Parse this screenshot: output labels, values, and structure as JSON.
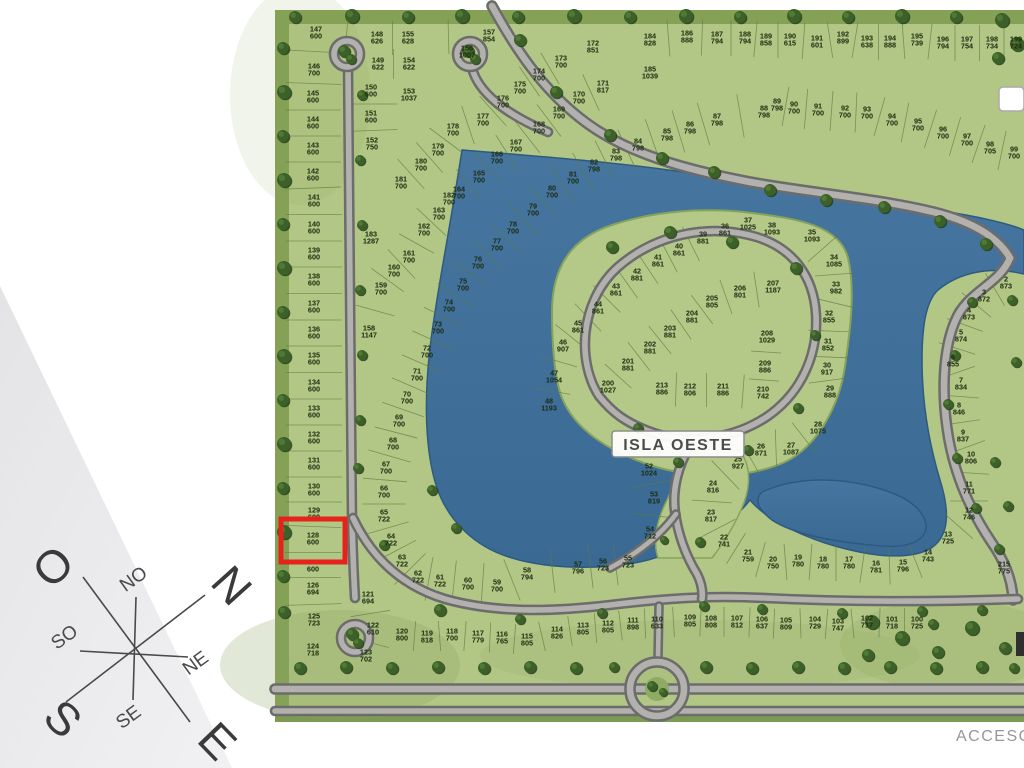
{
  "compass": {
    "directions": [
      {
        "id": "west",
        "label": "O"
      },
      {
        "id": "north",
        "label": "N"
      },
      {
        "id": "south",
        "label": "S"
      },
      {
        "id": "east",
        "label": "E"
      },
      {
        "id": "northwest",
        "label": "NO"
      },
      {
        "id": "southwest",
        "label": "SO"
      },
      {
        "id": "northeast",
        "label": "NE"
      },
      {
        "id": "southeast",
        "label": "SE"
      }
    ]
  },
  "map": {
    "island_label": "ISLA OESTE",
    "access_label": "ACCESO",
    "highlight": {
      "lot": 128,
      "x": 281,
      "y": 519,
      "w": 64,
      "h": 43
    },
    "colors": {
      "water": "#3f6f9b",
      "water_edge": "#2e5a80",
      "grass": "#b2c685",
      "grass_dark": "#84a156",
      "road": "#b3b1ae",
      "road_casing": "#6c6c6c",
      "tree": "#3c6028",
      "highlight": "#e5231b",
      "lot_text": "#1c2b10"
    },
    "lots": [
      {
        "n": 147,
        "a": 600,
        "x": 316,
        "y": 33
      },
      {
        "n": 146,
        "a": 700,
        "x": 314,
        "y": 70
      },
      {
        "n": 145,
        "a": 600,
        "x": 313,
        "y": 97
      },
      {
        "n": 144,
        "a": 600,
        "x": 313,
        "y": 123
      },
      {
        "n": 143,
        "a": 600,
        "x": 313,
        "y": 149
      },
      {
        "n": 142,
        "a": 600,
        "x": 313,
        "y": 175
      },
      {
        "n": 141,
        "a": 600,
        "x": 314,
        "y": 201
      },
      {
        "n": 140,
        "a": 600,
        "x": 314,
        "y": 228
      },
      {
        "n": 139,
        "a": 600,
        "x": 314,
        "y": 254
      },
      {
        "n": 138,
        "a": 600,
        "x": 314,
        "y": 280
      },
      {
        "n": 137,
        "a": 600,
        "x": 314,
        "y": 307
      },
      {
        "n": 136,
        "a": 600,
        "x": 314,
        "y": 333
      },
      {
        "n": 135,
        "a": 600,
        "x": 314,
        "y": 359
      },
      {
        "n": 134,
        "a": 600,
        "x": 314,
        "y": 386
      },
      {
        "n": 133,
        "a": 600,
        "x": 314,
        "y": 412
      },
      {
        "n": 132,
        "a": 600,
        "x": 314,
        "y": 438
      },
      {
        "n": 131,
        "a": 600,
        "x": 314,
        "y": 464
      },
      {
        "n": 130,
        "a": 600,
        "x": 314,
        "y": 490
      },
      {
        "n": 129,
        "a": 600,
        "x": 314,
        "y": 514
      },
      {
        "n": 128,
        "a": 600,
        "x": 313,
        "y": 539
      },
      {
        "n": 127,
        "a": 600,
        "x": 313,
        "y": 566
      },
      {
        "n": 126,
        "a": 694,
        "x": 313,
        "y": 589
      },
      {
        "n": 125,
        "a": 723,
        "x": 314,
        "y": 620
      },
      {
        "n": 124,
        "a": 718,
        "x": 313,
        "y": 650
      },
      {
        "n": 123,
        "a": 702,
        "x": 366,
        "y": 656
      },
      {
        "n": 122,
        "a": 610,
        "x": 373,
        "y": 629
      },
      {
        "n": 121,
        "a": 694,
        "x": 368,
        "y": 598
      },
      {
        "n": 148,
        "a": 626,
        "x": 377,
        "y": 38
      },
      {
        "n": 155,
        "a": 628,
        "x": 408,
        "y": 38
      },
      {
        "n": 157,
        "a": 854,
        "x": 489,
        "y": 36
      },
      {
        "n": 156,
        "a": 1007,
        "x": 467,
        "y": 52
      },
      {
        "n": 149,
        "a": 622,
        "x": 378,
        "y": 64
      },
      {
        "n": 154,
        "a": 622,
        "x": 409,
        "y": 64
      },
      {
        "n": 150,
        "a": 600,
        "x": 371,
        "y": 91
      },
      {
        "n": 153,
        "a": 1037,
        "x": 409,
        "y": 95
      },
      {
        "n": 151,
        "a": 600,
        "x": 371,
        "y": 117
      },
      {
        "n": 152,
        "a": 750,
        "x": 372,
        "y": 144
      },
      {
        "n": 183,
        "a": 1287,
        "x": 371,
        "y": 238
      },
      {
        "n": 158,
        "a": 1147,
        "x": 369,
        "y": 332
      },
      {
        "n": 159,
        "a": 700,
        "x": 381,
        "y": 289
      },
      {
        "n": 160,
        "a": 700,
        "x": 394,
        "y": 271
      },
      {
        "n": 161,
        "a": 700,
        "x": 409,
        "y": 257
      },
      {
        "n": 162,
        "a": 700,
        "x": 424,
        "y": 230
      },
      {
        "n": 163,
        "a": 700,
        "x": 439,
        "y": 214
      },
      {
        "n": 182,
        "a": 700,
        "x": 449,
        "y": 199
      },
      {
        "n": 164,
        "a": 700,
        "x": 459,
        "y": 193
      },
      {
        "n": 165,
        "a": 700,
        "x": 479,
        "y": 177
      },
      {
        "n": 166,
        "a": 700,
        "x": 497,
        "y": 158
      },
      {
        "n": 167,
        "a": 700,
        "x": 516,
        "y": 146
      },
      {
        "n": 168,
        "a": 700,
        "x": 539,
        "y": 128
      },
      {
        "n": 169,
        "a": 700,
        "x": 559,
        "y": 113
      },
      {
        "n": 170,
        "a": 700,
        "x": 579,
        "y": 98
      },
      {
        "n": 171,
        "a": 817,
        "x": 603,
        "y": 87
      },
      {
        "n": 172,
        "a": 851,
        "x": 593,
        "y": 47
      },
      {
        "n": 173,
        "a": 700,
        "x": 561,
        "y": 62
      },
      {
        "n": 174,
        "a": 700,
        "x": 539,
        "y": 75
      },
      {
        "n": 175,
        "a": 700,
        "x": 520,
        "y": 88
      },
      {
        "n": 176,
        "a": 700,
        "x": 503,
        "y": 102
      },
      {
        "n": 177,
        "a": 700,
        "x": 483,
        "y": 120
      },
      {
        "n": 178,
        "a": 700,
        "x": 453,
        "y": 130
      },
      {
        "n": 179,
        "a": 700,
        "x": 438,
        "y": 150
      },
      {
        "n": 180,
        "a": 700,
        "x": 421,
        "y": 165
      },
      {
        "n": 181,
        "a": 700,
        "x": 401,
        "y": 183
      },
      {
        "n": 184,
        "a": 828,
        "x": 650,
        "y": 40
      },
      {
        "n": 185,
        "a": 1039,
        "x": 650,
        "y": 73
      },
      {
        "n": 186,
        "a": 888,
        "x": 687,
        "y": 37
      },
      {
        "n": 187,
        "a": 794,
        "x": 717,
        "y": 38
      },
      {
        "n": 188,
        "a": 794,
        "x": 745,
        "y": 38
      },
      {
        "n": 189,
        "a": 858,
        "x": 766,
        "y": 40
      },
      {
        "n": 190,
        "a": 615,
        "x": 790,
        "y": 40
      },
      {
        "n": 191,
        "a": 601,
        "x": 817,
        "y": 42
      },
      {
        "n": 192,
        "a": 899,
        "x": 843,
        "y": 38
      },
      {
        "n": 193,
        "a": 638,
        "x": 867,
        "y": 42
      },
      {
        "n": 194,
        "a": 888,
        "x": 890,
        "y": 42
      },
      {
        "n": 195,
        "a": 739,
        "x": 917,
        "y": 40
      },
      {
        "n": 196,
        "a": 794,
        "x": 943,
        "y": 43
      },
      {
        "n": 197,
        "a": 754,
        "x": 967,
        "y": 43
      },
      {
        "n": 198,
        "a": 734,
        "x": 992,
        "y": 43
      },
      {
        "n": 199,
        "a": 724,
        "x": 1016,
        "y": 43
      },
      {
        "n": 89,
        "a": 798,
        "x": 777,
        "y": 105
      },
      {
        "n": 90,
        "a": 700,
        "x": 794,
        "y": 108
      },
      {
        "n": 91,
        "a": 700,
        "x": 818,
        "y": 110
      },
      {
        "n": 92,
        "a": 700,
        "x": 845,
        "y": 112
      },
      {
        "n": 93,
        "a": 700,
        "x": 867,
        "y": 113
      },
      {
        "n": 94,
        "a": 700,
        "x": 892,
        "y": 120
      },
      {
        "n": 95,
        "a": 700,
        "x": 918,
        "y": 125
      },
      {
        "n": 96,
        "a": 700,
        "x": 943,
        "y": 133
      },
      {
        "n": 97,
        "a": 700,
        "x": 967,
        "y": 140
      },
      {
        "n": 98,
        "a": 705,
        "x": 990,
        "y": 148
      },
      {
        "n": 99,
        "a": 700,
        "x": 1014,
        "y": 153
      },
      {
        "n": 88,
        "a": 798,
        "x": 764,
        "y": 112
      },
      {
        "n": 87,
        "a": 798,
        "x": 717,
        "y": 120
      },
      {
        "n": 86,
        "a": 798,
        "x": 690,
        "y": 128
      },
      {
        "n": 85,
        "a": 798,
        "x": 667,
        "y": 135
      },
      {
        "n": 84,
        "a": 798,
        "x": 638,
        "y": 145
      },
      {
        "n": 83,
        "a": 798,
        "x": 616,
        "y": 155
      },
      {
        "n": 82,
        "a": 798,
        "x": 594,
        "y": 166
      },
      {
        "n": 81,
        "a": 700,
        "x": 573,
        "y": 178
      },
      {
        "n": 80,
        "a": 700,
        "x": 552,
        "y": 192
      },
      {
        "n": 79,
        "a": 700,
        "x": 533,
        "y": 210
      },
      {
        "n": 78,
        "a": 700,
        "x": 513,
        "y": 228
      },
      {
        "n": 77,
        "a": 700,
        "x": 497,
        "y": 245
      },
      {
        "n": 76,
        "a": 700,
        "x": 478,
        "y": 263
      },
      {
        "n": 75,
        "a": 700,
        "x": 463,
        "y": 285
      },
      {
        "n": 74,
        "a": 700,
        "x": 449,
        "y": 306
      },
      {
        "n": 73,
        "a": 700,
        "x": 438,
        "y": 328
      },
      {
        "n": 72,
        "a": 700,
        "x": 427,
        "y": 352
      },
      {
        "n": 71,
        "a": 700,
        "x": 417,
        "y": 375
      },
      {
        "n": 70,
        "a": 700,
        "x": 407,
        "y": 398
      },
      {
        "n": 69,
        "a": 700,
        "x": 399,
        "y": 421
      },
      {
        "n": 68,
        "a": 700,
        "x": 393,
        "y": 444
      },
      {
        "n": 67,
        "a": 700,
        "x": 386,
        "y": 468
      },
      {
        "n": 66,
        "a": 700,
        "x": 384,
        "y": 492
      },
      {
        "n": 65,
        "a": 722,
        "x": 384,
        "y": 516
      },
      {
        "n": 64,
        "a": 722,
        "x": 391,
        "y": 540
      },
      {
        "n": 63,
        "a": 722,
        "x": 402,
        "y": 561
      },
      {
        "n": 62,
        "a": 722,
        "x": 418,
        "y": 577
      },
      {
        "n": 61,
        "a": 722,
        "x": 440,
        "y": 581
      },
      {
        "n": 60,
        "a": 700,
        "x": 468,
        "y": 584
      },
      {
        "n": 59,
        "a": 700,
        "x": 497,
        "y": 586
      },
      {
        "n": 58,
        "a": 794,
        "x": 527,
        "y": 574
      },
      {
        "n": 57,
        "a": 796,
        "x": 578,
        "y": 568
      },
      {
        "n": 56,
        "a": 723,
        "x": 603,
        "y": 565
      },
      {
        "n": 55,
        "a": 723,
        "x": 628,
        "y": 562
      },
      {
        "n": 120,
        "a": 800,
        "x": 402,
        "y": 635
      },
      {
        "n": 119,
        "a": 818,
        "x": 427,
        "y": 637
      },
      {
        "n": 118,
        "a": 700,
        "x": 452,
        "y": 635
      },
      {
        "n": 117,
        "a": 779,
        "x": 478,
        "y": 637
      },
      {
        "n": 116,
        "a": 765,
        "x": 502,
        "y": 638
      },
      {
        "n": 115,
        "a": 805,
        "x": 527,
        "y": 640
      },
      {
        "n": 114,
        "a": 826,
        "x": 557,
        "y": 633
      },
      {
        "n": 113,
        "a": 805,
        "x": 583,
        "y": 629
      },
      {
        "n": 112,
        "a": 805,
        "x": 608,
        "y": 627
      },
      {
        "n": 111,
        "a": 898,
        "x": 633,
        "y": 624
      },
      {
        "n": 110,
        "a": 633,
        "x": 657,
        "y": 623
      },
      {
        "n": 109,
        "a": 805,
        "x": 690,
        "y": 621
      },
      {
        "n": 108,
        "a": 808,
        "x": 711,
        "y": 622
      },
      {
        "n": 107,
        "a": 812,
        "x": 737,
        "y": 622
      },
      {
        "n": 106,
        "a": 637,
        "x": 762,
        "y": 623
      },
      {
        "n": 105,
        "a": 809,
        "x": 786,
        "y": 624
      },
      {
        "n": 104,
        "a": 729,
        "x": 815,
        "y": 623
      },
      {
        "n": 103,
        "a": 747,
        "x": 838,
        "y": 625
      },
      {
        "n": 102,
        "a": 717,
        "x": 867,
        "y": 622
      },
      {
        "n": 101,
        "a": 718,
        "x": 892,
        "y": 623
      },
      {
        "n": 100,
        "a": 725,
        "x": 917,
        "y": 623
      },
      {
        "n": 54,
        "a": 712,
        "x": 650,
        "y": 533
      },
      {
        "n": 53,
        "a": 819,
        "x": 654,
        "y": 498
      },
      {
        "n": 52,
        "a": 1024,
        "x": 649,
        "y": 470
      },
      {
        "n": 22,
        "a": 741,
        "x": 724,
        "y": 541
      },
      {
        "n": 21,
        "a": 759,
        "x": 748,
        "y": 556
      },
      {
        "n": 20,
        "a": 750,
        "x": 773,
        "y": 563
      },
      {
        "n": 19,
        "a": 780,
        "x": 798,
        "y": 561
      },
      {
        "n": 18,
        "a": 780,
        "x": 823,
        "y": 563
      },
      {
        "n": 17,
        "a": 780,
        "x": 849,
        "y": 563
      },
      {
        "n": 16,
        "a": 781,
        "x": 876,
        "y": 567
      },
      {
        "n": 15,
        "a": 796,
        "x": 903,
        "y": 566
      },
      {
        "n": 14,
        "a": 743,
        "x": 928,
        "y": 556
      },
      {
        "n": 23,
        "a": 817,
        "x": 711,
        "y": 516
      },
      {
        "n": 24,
        "a": 816,
        "x": 713,
        "y": 487
      },
      {
        "n": 25,
        "a": 927,
        "x": 738,
        "y": 463
      },
      {
        "n": 26,
        "a": 871,
        "x": 761,
        "y": 450
      },
      {
        "n": 27,
        "a": 1087,
        "x": 791,
        "y": 449
      },
      {
        "n": 28,
        "a": 1075,
        "x": 818,
        "y": 428
      },
      {
        "n": 13,
        "a": 725,
        "x": 948,
        "y": 538
      },
      {
        "n": 12,
        "a": 746,
        "x": 969,
        "y": 514
      },
      {
        "n": 11,
        "a": 771,
        "x": 969,
        "y": 488
      },
      {
        "n": 10,
        "a": 806,
        "x": 971,
        "y": 458
      },
      {
        "n": 9,
        "a": 837,
        "x": 963,
        "y": 436
      },
      {
        "n": 8,
        "a": 846,
        "x": 959,
        "y": 409
      },
      {
        "n": 7,
        "a": 834,
        "x": 961,
        "y": 384
      },
      {
        "n": 6,
        "a": 855,
        "x": 953,
        "y": 361
      },
      {
        "n": 5,
        "a": 874,
        "x": 961,
        "y": 336
      },
      {
        "n": 4,
        "a": 873,
        "x": 969,
        "y": 314
      },
      {
        "n": 3,
        "a": 872,
        "x": 984,
        "y": 296
      },
      {
        "n": 2,
        "a": 873,
        "x": 1006,
        "y": 283
      },
      {
        "n": 215,
        "a": 775,
        "x": 1004,
        "y": 568
      },
      {
        "n": 200,
        "a": 1027,
        "x": 608,
        "y": 387
      },
      {
        "n": 201,
        "a": 881,
        "x": 628,
        "y": 365
      },
      {
        "n": 202,
        "a": 881,
        "x": 650,
        "y": 348
      },
      {
        "n": 203,
        "a": 881,
        "x": 670,
        "y": 332
      },
      {
        "n": 204,
        "a": 881,
        "x": 692,
        "y": 317
      },
      {
        "n": 205,
        "a": 805,
        "x": 712,
        "y": 302
      },
      {
        "n": 206,
        "a": 801,
        "x": 740,
        "y": 292
      },
      {
        "n": 207,
        "a": 1187,
        "x": 773,
        "y": 287
      },
      {
        "n": 208,
        "a": 1029,
        "x": 767,
        "y": 337
      },
      {
        "n": 209,
        "a": 886,
        "x": 765,
        "y": 367
      },
      {
        "n": 210,
        "a": 742,
        "x": 763,
        "y": 393
      },
      {
        "n": 211,
        "a": 886,
        "x": 723,
        "y": 390
      },
      {
        "n": 212,
        "a": 806,
        "x": 690,
        "y": 390
      },
      {
        "n": 213,
        "a": 886,
        "x": 662,
        "y": 389
      },
      {
        "n": 39,
        "a": 881,
        "x": 703,
        "y": 238
      },
      {
        "n": 40,
        "a": 861,
        "x": 679,
        "y": 250
      },
      {
        "n": 41,
        "a": 861,
        "x": 658,
        "y": 261
      },
      {
        "n": 42,
        "a": 881,
        "x": 637,
        "y": 275
      },
      {
        "n": 43,
        "a": 861,
        "x": 616,
        "y": 290
      },
      {
        "n": 44,
        "a": 861,
        "x": 598,
        "y": 308
      },
      {
        "n": 45,
        "a": 861,
        "x": 578,
        "y": 327
      },
      {
        "n": 46,
        "a": 907,
        "x": 563,
        "y": 346
      },
      {
        "n": 47,
        "a": 1054,
        "x": 554,
        "y": 377
      },
      {
        "n": 48,
        "a": 1193,
        "x": 549,
        "y": 405
      },
      {
        "n": 36,
        "a": 861,
        "x": 725,
        "y": 230
      },
      {
        "n": 37,
        "a": 1025,
        "x": 748,
        "y": 224
      },
      {
        "n": 38,
        "a": 1093,
        "x": 772,
        "y": 229
      },
      {
        "n": 35,
        "a": 1093,
        "x": 812,
        "y": 236
      },
      {
        "n": 34,
        "a": 1085,
        "x": 834,
        "y": 261
      },
      {
        "n": 33,
        "a": 982,
        "x": 836,
        "y": 288
      },
      {
        "n": 32,
        "a": 855,
        "x": 829,
        "y": 317
      },
      {
        "n": 31,
        "a": 852,
        "x": 828,
        "y": 345
      },
      {
        "n": 30,
        "a": 917,
        "x": 827,
        "y": 369
      },
      {
        "n": 29,
        "a": 888,
        "x": 830,
        "y": 392
      }
    ]
  }
}
